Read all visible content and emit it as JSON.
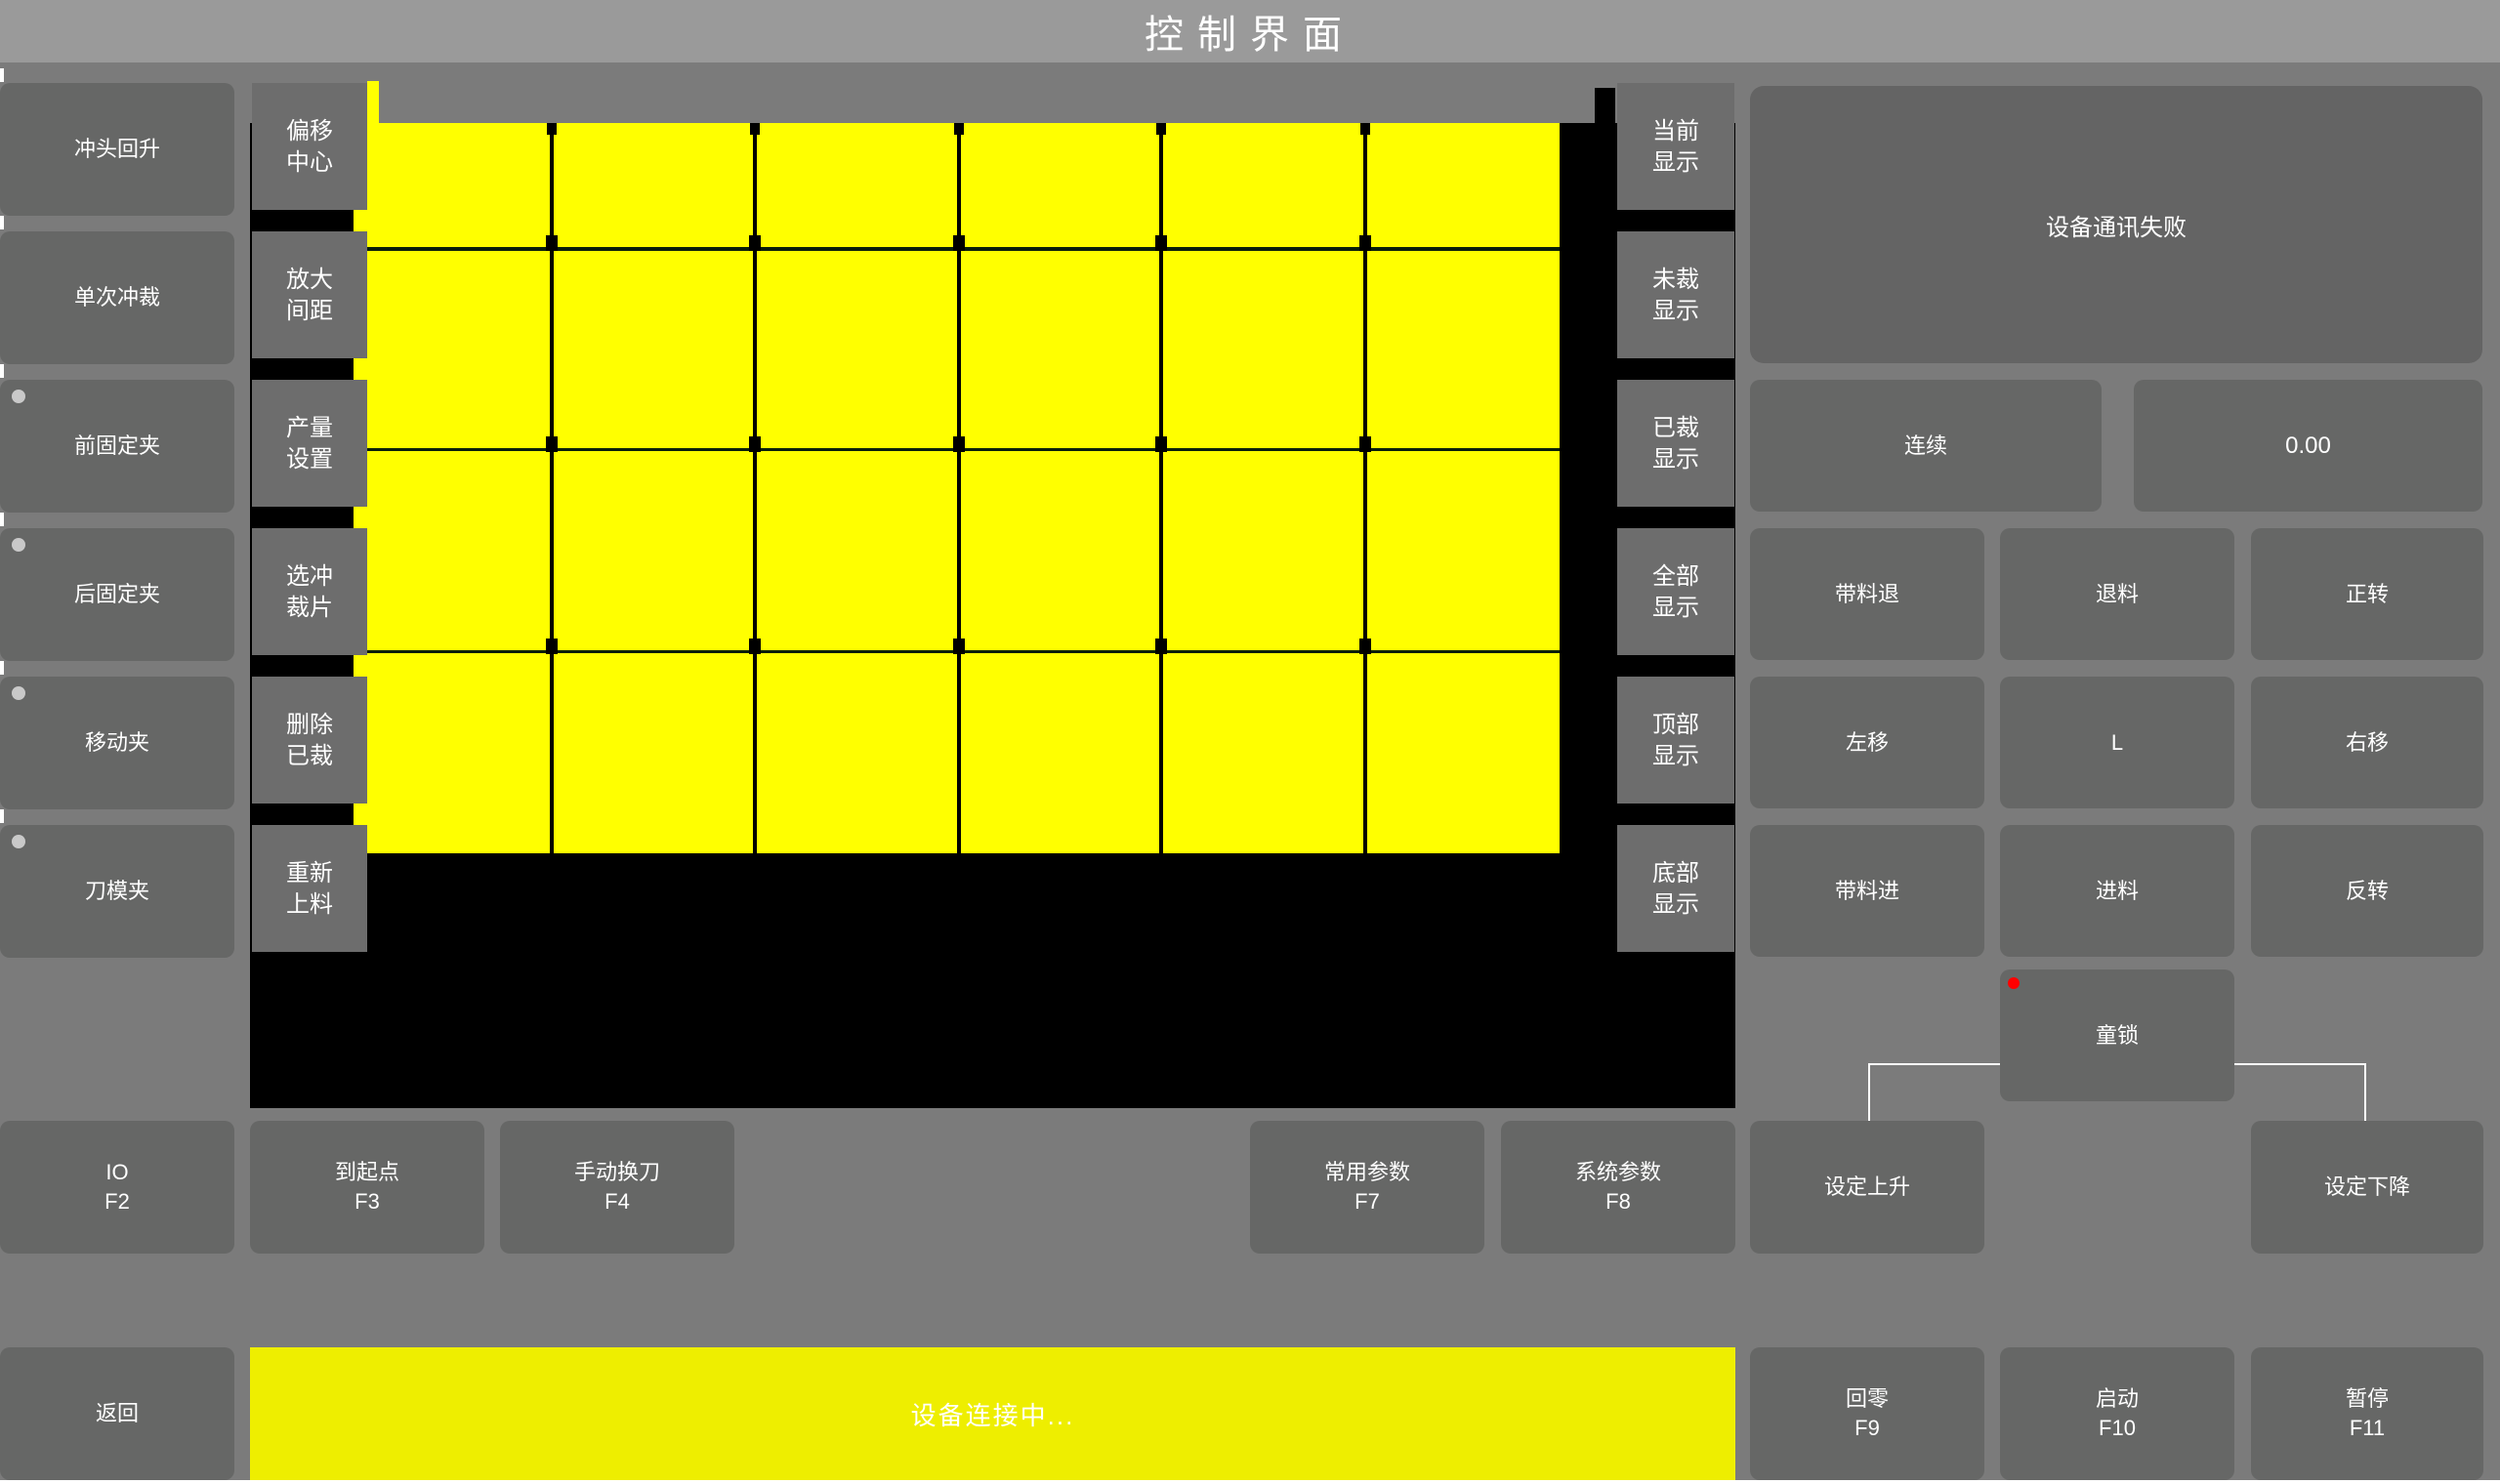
{
  "title": "控制界面",
  "colors": {
    "accent_yellow": "#ffff00",
    "status_yellow": "#eeee00",
    "alert_red": "#ff0000",
    "panel_gray": "#666766"
  },
  "left_panel": {
    "buttons": [
      {
        "label": "冲头回升",
        "indicator": false
      },
      {
        "label": "单次冲裁",
        "indicator": false
      },
      {
        "label": "前固定夹",
        "indicator": true
      },
      {
        "label": "后固定夹",
        "indicator": true
      },
      {
        "label": "移动夹",
        "indicator": true
      },
      {
        "label": "刀模夹",
        "indicator": true
      }
    ]
  },
  "tool_panel": {
    "buttons": [
      {
        "line1": "偏移",
        "line2": "中心"
      },
      {
        "line1": "放大",
        "line2": "间距"
      },
      {
        "line1": "产量",
        "line2": "设置"
      },
      {
        "line1": "选冲",
        "line2": "裁片"
      },
      {
        "line1": "删除",
        "line2": "已裁"
      },
      {
        "line1": "重新",
        "line2": "上料"
      }
    ]
  },
  "display_panel": {
    "buttons": [
      {
        "line1": "当前",
        "line2": "显示"
      },
      {
        "line1": "未裁",
        "line2": "显示"
      },
      {
        "line1": "已裁",
        "line2": "显示"
      },
      {
        "line1": "全部",
        "line2": "显示"
      },
      {
        "line1": "顶部",
        "line2": "显示"
      },
      {
        "line1": "底部",
        "line2": "显示"
      }
    ]
  },
  "sheet_grid": {
    "rows": 4,
    "cols": 6
  },
  "right_panel": {
    "message": "设备通讯失败",
    "mode_button": "连续",
    "value_display": "0.00",
    "jog_buttons": [
      "带料退",
      "退料",
      "正转",
      "左移",
      "L",
      "右移",
      "带料进",
      "进料",
      "反转"
    ],
    "child_lock": "童锁"
  },
  "function_row": {
    "buttons": [
      {
        "label": "IO",
        "key": "F2"
      },
      {
        "label": "到起点",
        "key": "F3"
      },
      {
        "label": "手动换刀",
        "key": "F4"
      },
      {
        "label": "常用参数",
        "key": "F7"
      },
      {
        "label": "系统参数",
        "key": "F8"
      },
      {
        "label": "设定上升",
        "key": ""
      },
      {
        "label": "设定下降",
        "key": ""
      }
    ]
  },
  "bottom_bar": {
    "back_button": "返回",
    "status_message": "设备连接中...",
    "action_buttons": [
      {
        "label": "回零",
        "key": "F9"
      },
      {
        "label": "启动",
        "key": "F10"
      },
      {
        "label": "暂停",
        "key": "F11"
      }
    ]
  }
}
